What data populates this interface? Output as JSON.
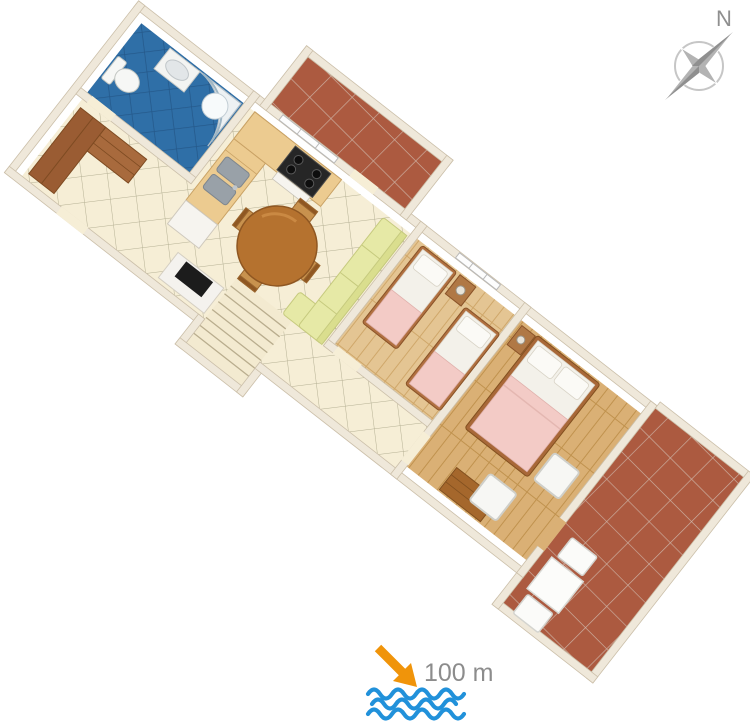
{
  "scene": {
    "kind": "3d-apartment-floor-plan"
  },
  "compass": {
    "label": "N"
  },
  "distance": {
    "label": "100 m"
  },
  "icons": [
    {
      "name": "compass-rose-icon"
    },
    {
      "name": "direction-arrow-icon"
    },
    {
      "name": "sea-waves-icon"
    }
  ],
  "rooms": [
    {
      "name": "entry-hall",
      "floor": "cream-tile"
    },
    {
      "name": "bathroom",
      "floor": "blue-tile"
    },
    {
      "name": "kitchen",
      "floor": "cream-tile"
    },
    {
      "name": "living-dining-room",
      "floor": "cream-tile"
    },
    {
      "name": "balcony",
      "floor": "terracotta-tile"
    },
    {
      "name": "stairs-hallway",
      "floor": "cream-tile"
    },
    {
      "name": "twin-bedroom",
      "floor": "wood"
    },
    {
      "name": "double-bedroom",
      "floor": "wood"
    },
    {
      "name": "terrace",
      "floor": "terracotta-tile"
    }
  ],
  "colors": {
    "wall": "#efe8da",
    "tile_floor": "#f6eed6",
    "bathroom_floor": "#2f6fa7",
    "terrace_floor": "#ac5a40",
    "wood_floor_light": "#e4c593",
    "wood_floor_dark": "#dab075",
    "sofa": "#e6e9a6",
    "bed_blanket": "#f3cbc6",
    "counter": "#eccb90",
    "arrow": "#f0940a",
    "waves": "#2191da",
    "compass_gray": "#b3b3b3",
    "label_gray": "#8c8c8c"
  }
}
